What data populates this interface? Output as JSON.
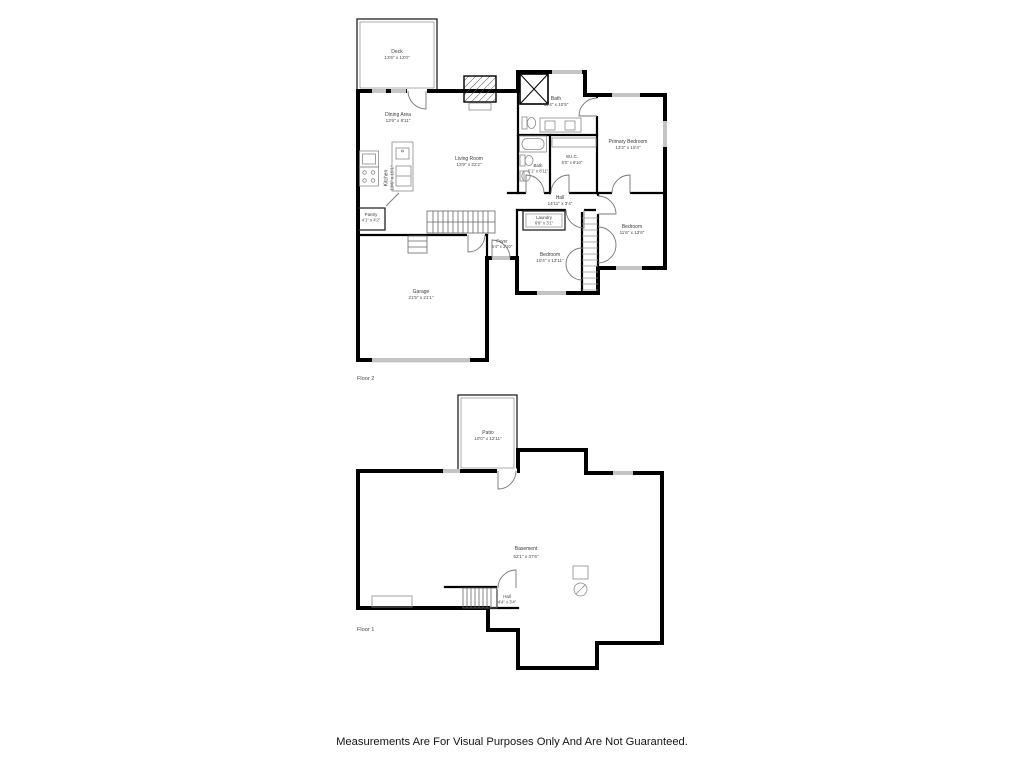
{
  "disclaimer": "Measurements Are For Visual Purposes Only And Are Not Guaranteed.",
  "colors": {
    "wall": "#000000",
    "window": "#c4c4c4",
    "fixture": "#8a8a8a",
    "label": "#3a3a3a"
  },
  "floor2": {
    "label": "Floor 2",
    "rooms": {
      "deck": {
        "name": "Deck",
        "dims": "13'6\" x 12'0\""
      },
      "dining": {
        "name": "Dining Area",
        "dims": "13'6\" x 8'11\""
      },
      "kitchen": {
        "name": "Kitchen",
        "dims": "13'6\" x 15'1\""
      },
      "living": {
        "name": "Living Room",
        "dims": "13'9\" x 22'2\""
      },
      "pantry": {
        "name": "Pantry",
        "dims": "4'1\" x 4'2\""
      },
      "bath_main": {
        "name": "Bath",
        "dims": "11'4\" x 10'5\""
      },
      "primary_bedroom": {
        "name": "Primary Bedroom",
        "dims": "13'2\" x 15'4\""
      },
      "wic": {
        "name": "W.I.C.",
        "dims": "6'0\" x 8'10\""
      },
      "bath_small": {
        "name": "Bath",
        "dims": "5'1\" x 8'11\""
      },
      "hall": {
        "name": "Hall",
        "dims": "14'11\" x 3'4\""
      },
      "laundry": {
        "name": "Laundry",
        "dims": "6'9\" x 3'1\""
      },
      "foyer": {
        "name": "Foyer",
        "dims": "5'4\" x 3'10\""
      },
      "bedroom_mid": {
        "name": "Bedroom",
        "dims": "10'4\" x 13'11\""
      },
      "bedroom_right": {
        "name": "Bedroom",
        "dims": "11'6\" x 13'6\""
      },
      "garage": {
        "name": "Garage",
        "dims": "21'5\" x 21'1\""
      }
    }
  },
  "floor1": {
    "label": "Floor 1",
    "rooms": {
      "patio": {
        "name": "Patio",
        "dims": "10'0\" x 12'11\""
      },
      "basement": {
        "name": "Basement",
        "dims": "52'1\" x 37'6\""
      },
      "hall": {
        "name": "Hall",
        "dims": "4'4\" x 3'4\""
      }
    }
  }
}
